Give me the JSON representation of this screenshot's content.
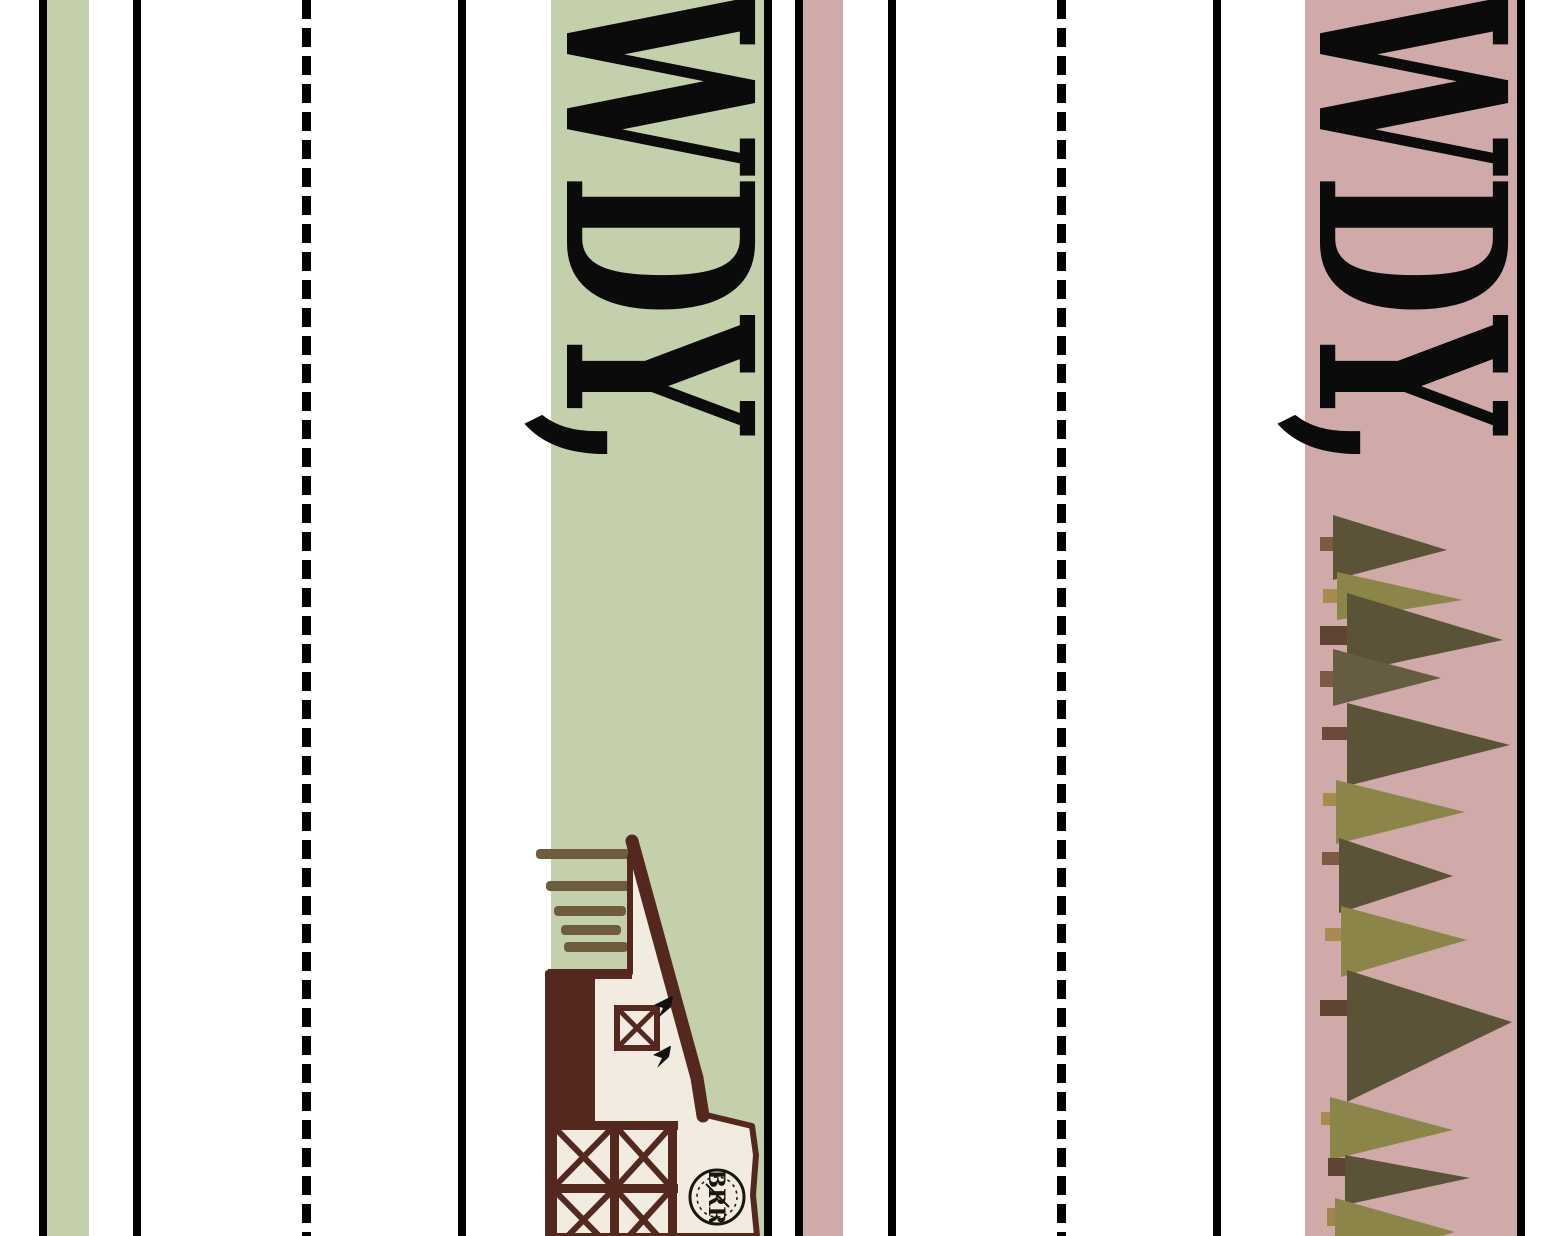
{
  "sheet": {
    "description": "Printable HOWDY bookmark cutting sheet, two colorways, artwork rotated 90 degrees",
    "background": "#ffffff",
    "width_px": 1545,
    "height_px": 1236
  },
  "colors": {
    "cut_line_black": "#010101",
    "sage_green": "#c3d0ab",
    "dusty_rose": "#cfaaa9",
    "barn_cream": "#f1ecdf",
    "barn_maroon": "#54281f",
    "roof_shingle_brown": "#6d5d3c",
    "tree_dark_olive": "#5a5338",
    "tree_light_olive": "#8b8549",
    "trunk_brown": "#7c5a44",
    "trunk_tan": "#a8894e",
    "trunk_dark": "#5f4433",
    "text_black": "#0b0b0b",
    "logo_ink": "#191611"
  },
  "bookmarks": [
    {
      "id": "sage-bookmark",
      "label": "HOWDY,",
      "visible_text": "WDY,",
      "panel_color": "#c3d0ab",
      "illustration": "barn",
      "logo_text": "BRR"
    },
    {
      "id": "rose-bookmark",
      "label": "HOWDY,",
      "visible_text": "WDY,",
      "panel_color": "#cfaaa9",
      "illustration": "pine-forest"
    }
  ],
  "guides": {
    "solid_cut_line_count": 8,
    "dashed_fold_line_count": 2,
    "dash_pattern_px": "19 9"
  }
}
